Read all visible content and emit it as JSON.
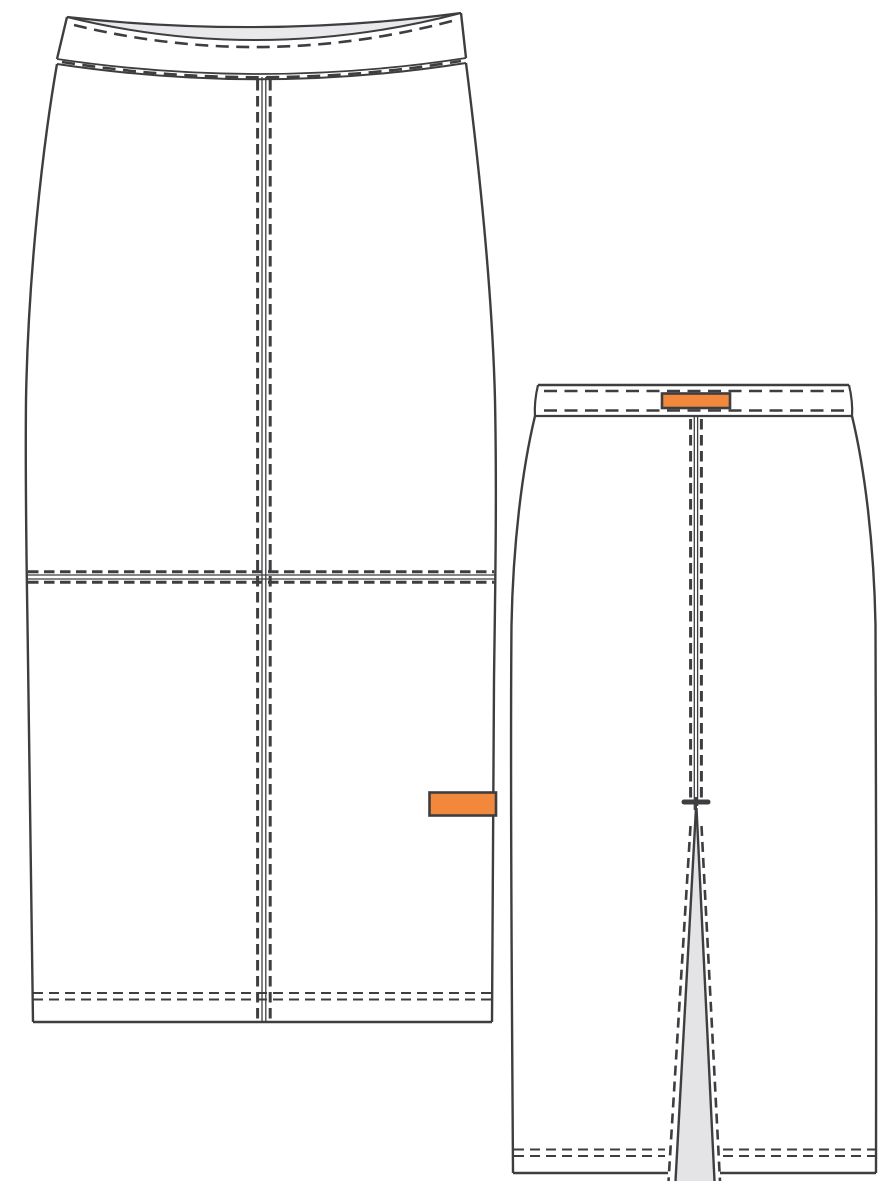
{
  "document": {
    "type": "fashion-technical-flat-sketch",
    "garment": "pencil-skirt",
    "background": "#ffffff"
  },
  "colors": {
    "background": "#ffffff",
    "outline": "#3e3e40",
    "inside_fabric": "#e9e9eb",
    "vent_fabric": "#e4e4e6",
    "label_fill": "#f1883c"
  },
  "views": {
    "front": {
      "name": "front-view",
      "parts": [
        "curved-waistband-with-topstitch",
        "waistband-inside-visible",
        "center-front-seam-double-topstitch",
        "horizontal-hip-seam-double-topstitch",
        "shaped-side-seams",
        "hem-double-topstitch",
        "orange-side-seam-label"
      ]
    },
    "back": {
      "name": "back-view",
      "parts": [
        "straight-waistband-with-topstitch",
        "orange-center-back-waistband-label",
        "center-back-seam-topstitch",
        "bartack-above-vent",
        "open-back-vent-with-shadow",
        "vent-edge-topstitch",
        "hem-double-topstitch"
      ]
    }
  }
}
